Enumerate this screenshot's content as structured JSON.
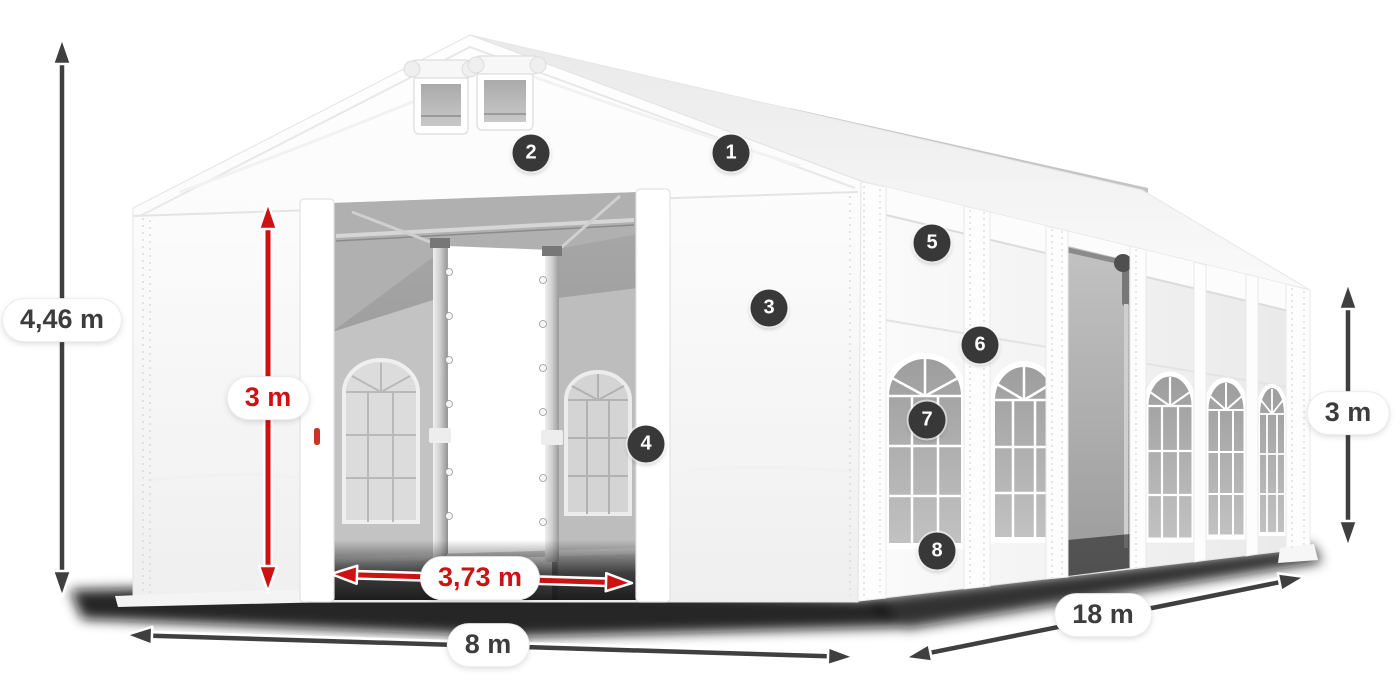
{
  "dimensions": {
    "total_height": {
      "label": "4,46 m"
    },
    "door_height": {
      "label": "3 m"
    },
    "door_width": {
      "label": "3,73 m"
    },
    "front_width": {
      "label": "8 m"
    },
    "length": {
      "label": "18 m"
    },
    "side_height": {
      "label": "3 m"
    }
  },
  "callouts": [
    {
      "number": "1"
    },
    {
      "number": "2"
    },
    {
      "number": "3"
    },
    {
      "number": "4"
    },
    {
      "number": "5"
    },
    {
      "number": "6"
    },
    {
      "number": "7"
    },
    {
      "number": "8"
    }
  ],
  "colors": {
    "dimension_dark": "#3f3f3f",
    "dimension_red": "#cc1212",
    "callout_background": "#383838",
    "callout_text": "#ffffff",
    "label_background": "#ffffff",
    "tent_white": "#fbfbfb",
    "interior_gray": "#9c9c9c"
  }
}
